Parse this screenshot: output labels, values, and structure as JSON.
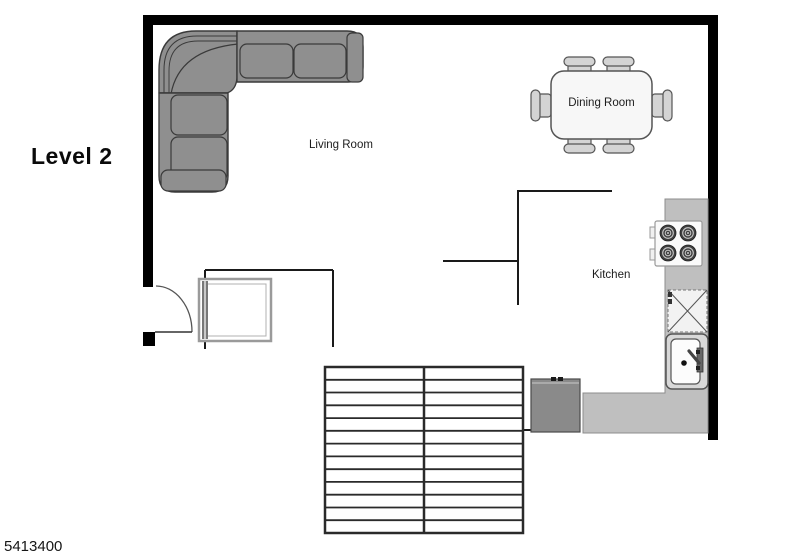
{
  "floorplan": {
    "level_label": "Level 2",
    "listing_id": "5413400",
    "rooms": {
      "living": "Living Room",
      "dining": "Dining Room",
      "kitchen": "Kitchen"
    },
    "colors": {
      "background": "#ffffff",
      "wall": "#000000",
      "interior_wall": "#1a1a1a",
      "sofa_fill": "#8f8f8f",
      "sofa_outline": "#3a3a3a",
      "counter_fill": "#bfbfbf",
      "appliance_fill": "#8a8a8a",
      "chair_fill": "#d4d4d4",
      "table_fill": "#f7f7f7",
      "sink_fill": "#d8d8d8",
      "stove_fill": "#fafafa",
      "burner_fill": "#3f3f3f"
    }
  }
}
